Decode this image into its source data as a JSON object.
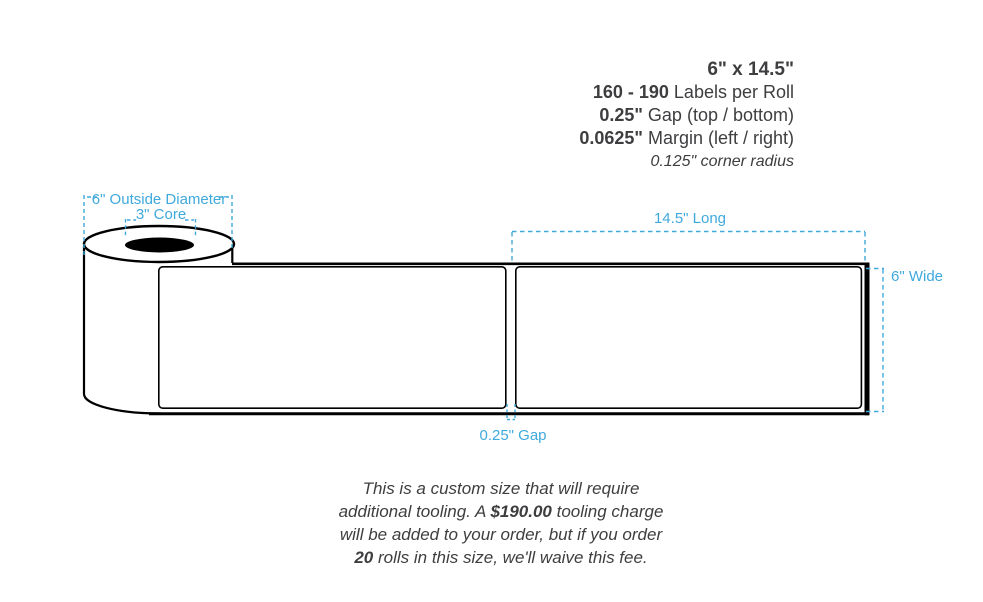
{
  "colors": {
    "annotation_blue": "#3FA9DC",
    "text_dark": "#3E3E40",
    "outline_black": "#000000",
    "core_fill": "#000000",
    "label_fill": "#ffffff"
  },
  "specs": {
    "title": "6\" x 14.5\"",
    "lines": [
      {
        "strong": "160 - 190",
        "rest": " Labels per Roll"
      },
      {
        "strong": "0.25\"",
        "rest": " Gap (top / bottom)"
      },
      {
        "strong": "0.0625\"",
        "rest": " Margin (left / right)"
      }
    ],
    "footnote": "0.125\" corner radius"
  },
  "annotations": {
    "outside_diameter": "6\" Outside Diameter",
    "core": "3\" Core",
    "length": "14.5\" Long",
    "width": "6\" Wide",
    "gap": "0.25\" Gap"
  },
  "tooling_note": {
    "segments": [
      {
        "text": "This is a custom size that will require additional tooling. A ",
        "bold": false
      },
      {
        "text": "$190.00",
        "bold": true
      },
      {
        "text": " tooling charge will be added to your order, but if you order ",
        "bold": false
      },
      {
        "text": "20",
        "bold": true
      },
      {
        "text": " rolls in this size, we'll waive this fee.",
        "bold": false
      }
    ]
  }
}
